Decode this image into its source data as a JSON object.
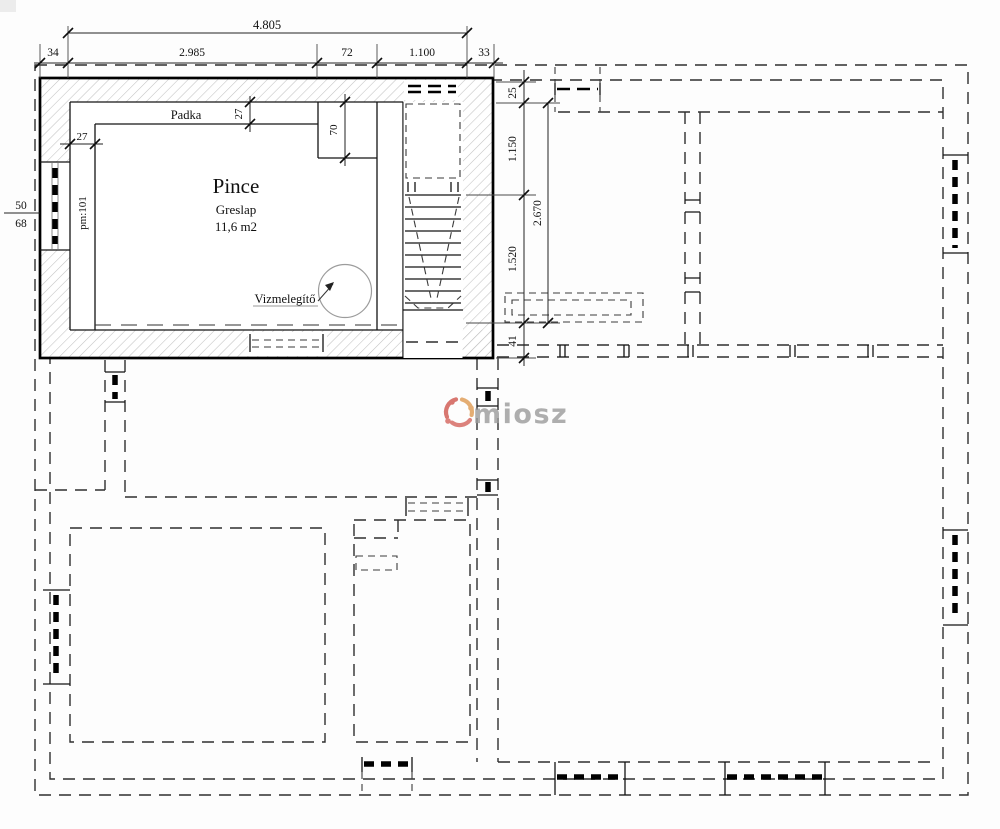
{
  "drawing": {
    "room": {
      "name": "Pince",
      "floor_finish": "Greslap",
      "area": "11,6 m2",
      "ledge_label": "Padka",
      "water_heater_label": "Vizmelegítő",
      "door_mark": "pm:101"
    },
    "dimensions": {
      "top_overall": "4.805",
      "top_chain": [
        "34",
        "2.985",
        "72",
        "1.100",
        "33"
      ],
      "right_overall": "2.670",
      "right_chain": [
        "25",
        "1.150",
        "1.520",
        "41"
      ],
      "left_window": {
        "width": "50",
        "height": "68"
      },
      "ledge_left": "27",
      "ledge_top": "27",
      "ledge_step": "70"
    },
    "watermark": {
      "text": "miosz",
      "logo_color": "#cf564e",
      "accent_color": "#df9a51",
      "text_color": "#9b9b9b"
    },
    "colors": {
      "line": "#141414",
      "hatch": "#c2c2c2",
      "dash": "#2f2f2f"
    }
  }
}
